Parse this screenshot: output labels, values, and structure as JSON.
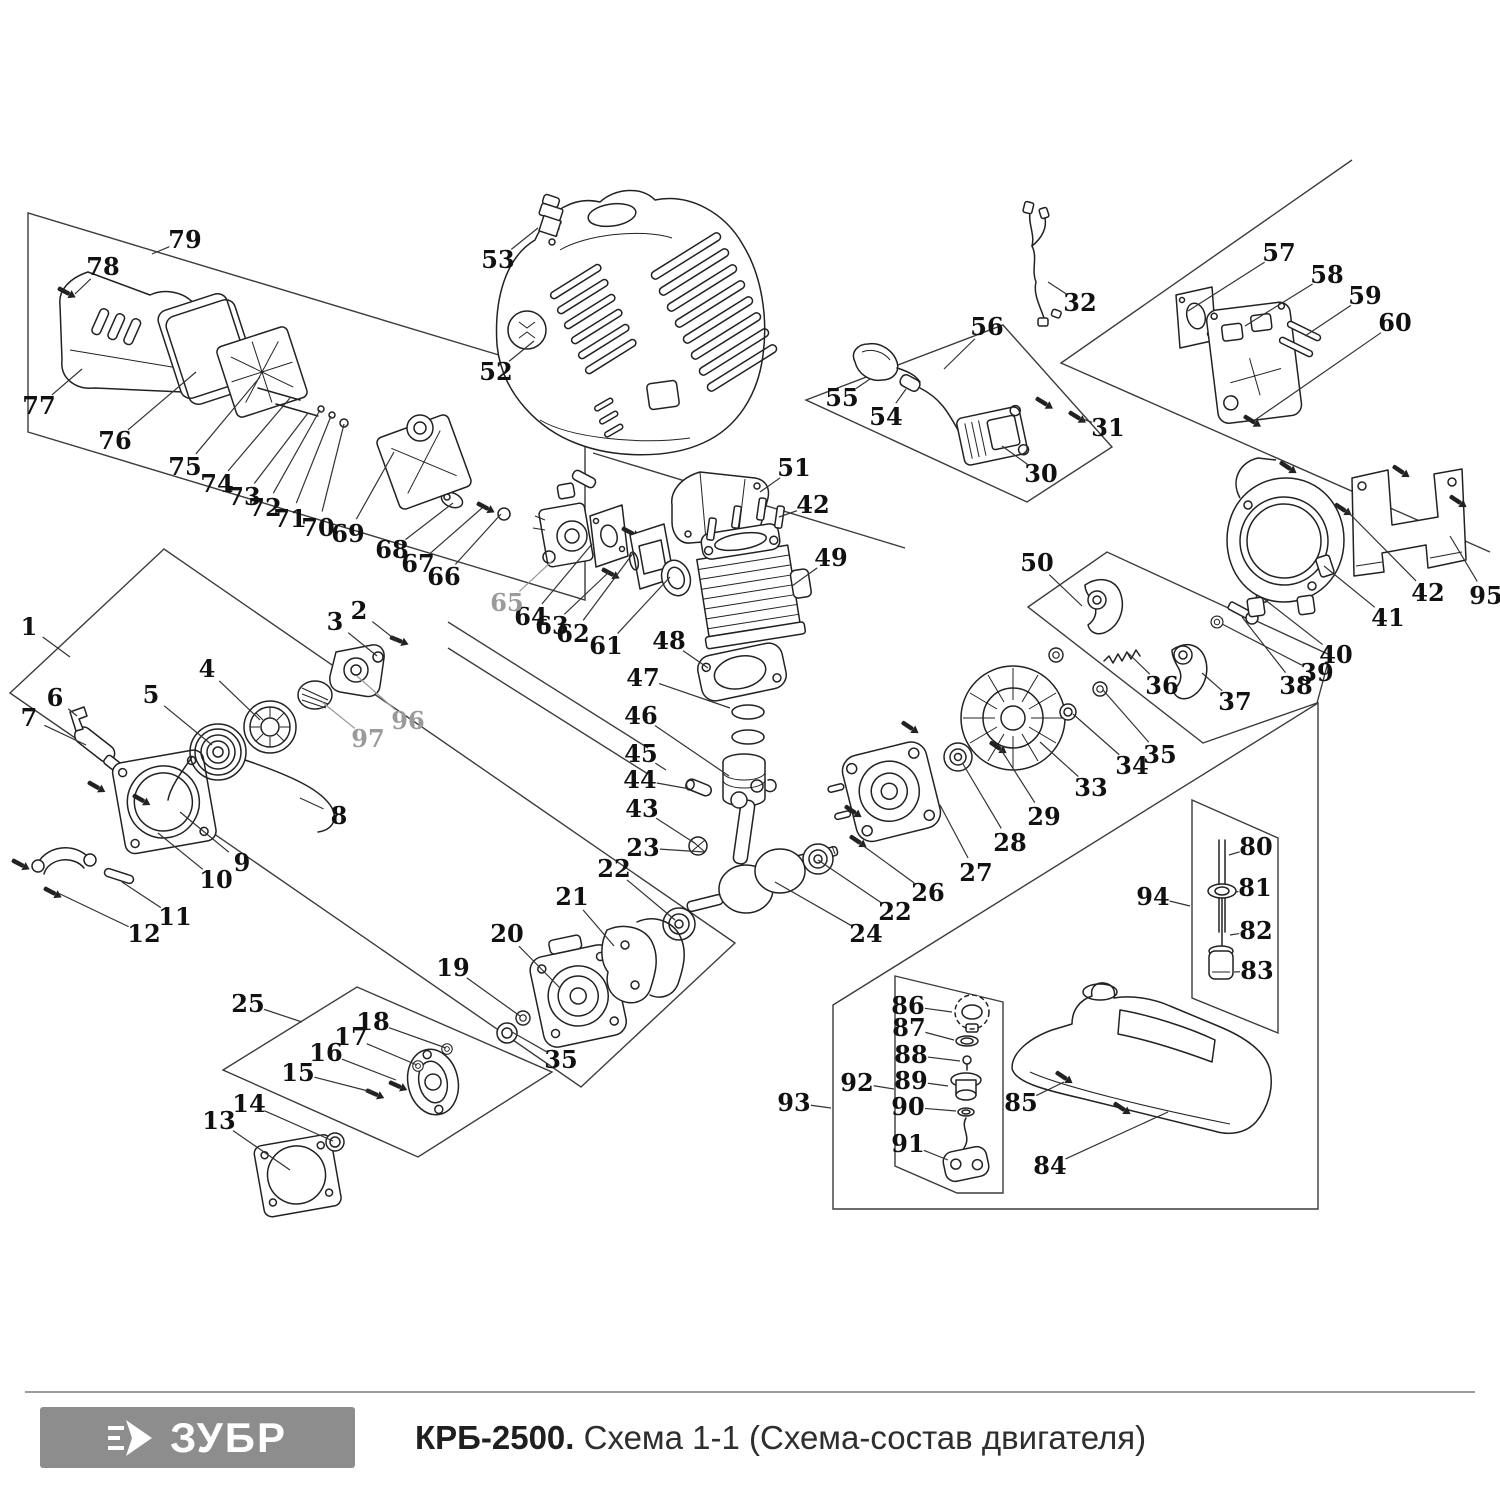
{
  "diagram": {
    "label_color": "#111111",
    "muted_label_color": "#9a9a9a",
    "leader_color": "#333333",
    "labels": [
      {
        "n": "1",
        "x": 29,
        "y": 627,
        "tx": 70,
        "ty": 657
      },
      {
        "n": "2",
        "x": 359,
        "y": 611,
        "tx": 397,
        "ty": 641
      },
      {
        "n": "3",
        "x": 335,
        "y": 622,
        "tx": 377,
        "ty": 656
      },
      {
        "n": "4",
        "x": 207,
        "y": 669,
        "tx": 260,
        "ty": 720
      },
      {
        "n": "5",
        "x": 151,
        "y": 695,
        "tx": 212,
        "ty": 745
      },
      {
        "n": "6",
        "x": 55,
        "y": 698,
        "tx": 77,
        "ty": 716
      },
      {
        "n": "7",
        "x": 29,
        "y": 718,
        "tx": 86,
        "ty": 745
      },
      {
        "n": "8",
        "x": 339,
        "y": 816,
        "tx": 300,
        "ty": 798
      },
      {
        "n": "9",
        "x": 242,
        "y": 863,
        "tx": 180,
        "ty": 812
      },
      {
        "n": "10",
        "x": 216,
        "y": 880,
        "tx": 158,
        "ty": 833
      },
      {
        "n": "11",
        "x": 175,
        "y": 917,
        "tx": 122,
        "ty": 882
      },
      {
        "n": "12",
        "x": 144,
        "y": 934,
        "tx": 58,
        "ty": 893
      },
      {
        "n": "13",
        "x": 219,
        "y": 1121,
        "tx": 290,
        "ty": 1170
      },
      {
        "n": "14",
        "x": 249,
        "y": 1104,
        "tx": 333,
        "ty": 1141
      },
      {
        "n": "15",
        "x": 298,
        "y": 1073,
        "tx": 372,
        "ty": 1092
      },
      {
        "n": "16",
        "x": 326,
        "y": 1053,
        "tx": 396,
        "ty": 1080
      },
      {
        "n": "17",
        "x": 351,
        "y": 1037,
        "tx": 417,
        "ty": 1065
      },
      {
        "n": "18",
        "x": 373,
        "y": 1022,
        "tx": 446,
        "ty": 1048
      },
      {
        "n": "19",
        "x": 453,
        "y": 968,
        "tx": 520,
        "ty": 1016
      },
      {
        "n": "20",
        "x": 507,
        "y": 934,
        "tx": 560,
        "ty": 988
      },
      {
        "n": "21",
        "x": 572,
        "y": 897,
        "tx": 614,
        "ty": 946
      },
      {
        "n": "22",
        "x": 614,
        "y": 869,
        "tx": 675,
        "ty": 920
      },
      {
        "n": "23",
        "x": 643,
        "y": 848,
        "tx": 704,
        "ty": 852
      },
      {
        "n": "24",
        "x": 866,
        "y": 934,
        "tx": 775,
        "ty": 882
      },
      {
        "n": "22",
        "x": 895,
        "y": 912,
        "tx": 818,
        "ty": 860
      },
      {
        "n": "25",
        "x": 248,
        "y": 1004,
        "tx": 302,
        "ty": 1022
      },
      {
        "n": "26",
        "x": 928,
        "y": 893,
        "tx": 858,
        "ty": 842
      },
      {
        "n": "27",
        "x": 976,
        "y": 873,
        "tx": 940,
        "ty": 805
      },
      {
        "n": "28",
        "x": 1010,
        "y": 843,
        "tx": 963,
        "ty": 764
      },
      {
        "n": "29",
        "x": 1044,
        "y": 817,
        "tx": 1000,
        "ty": 748
      },
      {
        "n": "30",
        "x": 1041,
        "y": 474,
        "tx": 1002,
        "ty": 446
      },
      {
        "n": "31",
        "x": 1108,
        "y": 428,
        "tx": 1080,
        "ty": 418
      },
      {
        "n": "32",
        "x": 1080,
        "y": 303,
        "tx": 1048,
        "ty": 282
      },
      {
        "n": "33",
        "x": 1091,
        "y": 788,
        "tx": 1040,
        "ty": 742
      },
      {
        "n": "34",
        "x": 1132,
        "y": 766,
        "tx": 1073,
        "ty": 714
      },
      {
        "n": "35",
        "x": 1160,
        "y": 755,
        "tx": 1103,
        "ty": 690
      },
      {
        "n": "36",
        "x": 1162,
        "y": 686,
        "tx": 1128,
        "ty": 653
      },
      {
        "n": "37",
        "x": 1235,
        "y": 702,
        "tx": 1202,
        "ty": 673
      },
      {
        "n": "38",
        "x": 1296,
        "y": 686,
        "tx": 1242,
        "ty": 617
      },
      {
        "n": "39",
        "x": 1317,
        "y": 673,
        "tx": 1222,
        "ty": 624
      },
      {
        "n": "40",
        "x": 1336,
        "y": 655,
        "tx": 1264,
        "ty": 599
      },
      {
        "n": "41",
        "x": 1388,
        "y": 618,
        "tx": 1324,
        "ty": 566
      },
      {
        "n": "42",
        "x": 813,
        "y": 505,
        "tx": 779,
        "ty": 517
      },
      {
        "n": "42",
        "x": 1428,
        "y": 593,
        "tx": 1345,
        "ty": 509
      },
      {
        "n": "43",
        "x": 642,
        "y": 809,
        "tx": 696,
        "ty": 844
      },
      {
        "n": "44",
        "x": 640,
        "y": 780,
        "tx": 690,
        "ty": 789
      },
      {
        "n": "45",
        "x": 641,
        "y": 754,
        "tx": 666,
        "ty": 770
      },
      {
        "n": "46",
        "x": 641,
        "y": 716,
        "tx": 729,
        "ty": 776
      },
      {
        "n": "47",
        "x": 643,
        "y": 678,
        "tx": 730,
        "ty": 708
      },
      {
        "n": "48",
        "x": 669,
        "y": 641,
        "tx": 708,
        "ty": 668
      },
      {
        "n": "49",
        "x": 831,
        "y": 558,
        "tx": 792,
        "ty": 586
      },
      {
        "n": "50",
        "x": 1037,
        "y": 563,
        "tx": 1082,
        "ty": 606
      },
      {
        "n": "51",
        "x": 794,
        "y": 468,
        "tx": 760,
        "ty": 492
      },
      {
        "n": "52",
        "x": 496,
        "y": 372,
        "tx": 534,
        "ty": 341
      },
      {
        "n": "53",
        "x": 498,
        "y": 260,
        "tx": 538,
        "ty": 228
      },
      {
        "n": "54",
        "x": 886,
        "y": 417,
        "tx": 906,
        "ty": 389
      },
      {
        "n": "55",
        "x": 842,
        "y": 398,
        "tx": 870,
        "ty": 379
      },
      {
        "n": "56",
        "x": 987,
        "y": 327,
        "tx": 944,
        "ty": 369
      },
      {
        "n": "57",
        "x": 1279,
        "y": 253,
        "tx": 1188,
        "ty": 311
      },
      {
        "n": "58",
        "x": 1327,
        "y": 275,
        "tx": 1245,
        "ty": 326
      },
      {
        "n": "59",
        "x": 1365,
        "y": 296,
        "tx": 1305,
        "ty": 336
      },
      {
        "n": "60",
        "x": 1395,
        "y": 323,
        "tx": 1255,
        "ty": 420
      },
      {
        "n": "61",
        "x": 606,
        "y": 646,
        "tx": 670,
        "ty": 577
      },
      {
        "n": "62",
        "x": 573,
        "y": 634,
        "tx": 634,
        "ty": 552
      },
      {
        "n": "63",
        "x": 552,
        "y": 626,
        "tx": 609,
        "ty": 572
      },
      {
        "n": "64",
        "x": 531,
        "y": 617,
        "tx": 592,
        "ty": 544
      },
      {
        "n": "65",
        "x": 507,
        "y": 603,
        "tx": 552,
        "ty": 561,
        "muted": true
      },
      {
        "n": "66",
        "x": 444,
        "y": 577,
        "tx": 501,
        "ty": 514
      },
      {
        "n": "67",
        "x": 418,
        "y": 564,
        "tx": 482,
        "ty": 508
      },
      {
        "n": "68",
        "x": 392,
        "y": 550,
        "tx": 453,
        "ty": 503
      },
      {
        "n": "69",
        "x": 348,
        "y": 534,
        "tx": 394,
        "ty": 452
      },
      {
        "n": "70",
        "x": 318,
        "y": 528,
        "tx": 344,
        "ty": 424
      },
      {
        "n": "71",
        "x": 290,
        "y": 519,
        "tx": 331,
        "ty": 416
      },
      {
        "n": "72",
        "x": 265,
        "y": 508,
        "tx": 320,
        "ty": 410
      },
      {
        "n": "73",
        "x": 244,
        "y": 497,
        "tx": 308,
        "ty": 413
      },
      {
        "n": "74",
        "x": 217,
        "y": 484,
        "tx": 290,
        "ty": 398
      },
      {
        "n": "75",
        "x": 185,
        "y": 467,
        "tx": 260,
        "ty": 377
      },
      {
        "n": "76",
        "x": 115,
        "y": 441,
        "tx": 196,
        "ty": 372
      },
      {
        "n": "77",
        "x": 39,
        "y": 406,
        "tx": 82,
        "ty": 369
      },
      {
        "n": "78",
        "x": 103,
        "y": 267,
        "tx": 75,
        "ty": 294
      },
      {
        "n": "79",
        "x": 185,
        "y": 240,
        "tx": 152,
        "ty": 254
      },
      {
        "n": "80",
        "x": 1256,
        "y": 847,
        "tx": 1229,
        "ty": 855
      },
      {
        "n": "81",
        "x": 1255,
        "y": 888,
        "tx": 1236,
        "ty": 892
      },
      {
        "n": "82",
        "x": 1256,
        "y": 931,
        "tx": 1230,
        "ty": 935
      },
      {
        "n": "83",
        "x": 1257,
        "y": 971,
        "tx": 1234,
        "ty": 972
      },
      {
        "n": "84",
        "x": 1050,
        "y": 1166,
        "tx": 1168,
        "ty": 1112
      },
      {
        "n": "85",
        "x": 1021,
        "y": 1103,
        "tx": 1064,
        "ty": 1082
      },
      {
        "n": "86",
        "x": 908,
        "y": 1006,
        "tx": 952,
        "ty": 1012
      },
      {
        "n": "87",
        "x": 909,
        "y": 1028,
        "tx": 954,
        "ty": 1040
      },
      {
        "n": "88",
        "x": 911,
        "y": 1055,
        "tx": 960,
        "ty": 1061
      },
      {
        "n": "89",
        "x": 911,
        "y": 1081,
        "tx": 948,
        "ty": 1086
      },
      {
        "n": "90",
        "x": 908,
        "y": 1107,
        "tx": 956,
        "ty": 1111
      },
      {
        "n": "91",
        "x": 908,
        "y": 1144,
        "tx": 948,
        "ty": 1160
      },
      {
        "n": "92",
        "x": 857,
        "y": 1083,
        "tx": 894,
        "ty": 1089
      },
      {
        "n": "93",
        "x": 794,
        "y": 1103,
        "tx": 831,
        "ty": 1108
      },
      {
        "n": "94",
        "x": 1153,
        "y": 897,
        "tx": 1190,
        "ty": 906
      },
      {
        "n": "95",
        "x": 1486,
        "y": 596,
        "tx": 1450,
        "ty": 536
      },
      {
        "n": "96",
        "x": 408,
        "y": 721,
        "tx": 357,
        "ty": 676,
        "muted": true
      },
      {
        "n": "97",
        "x": 368,
        "y": 739,
        "tx": 322,
        "ty": 702,
        "muted": true
      },
      {
        "n": "35",
        "x": 561,
        "y": 1060,
        "tx": 512,
        "ty": 1032
      }
    ]
  },
  "footer": {
    "separator_color": "#9c9c9c",
    "logo": {
      "text": "ЗУБР",
      "bg": "#8d8d8d",
      "fg": "#ffffff"
    },
    "title": {
      "model": "КРБ-2500.",
      "schema": " Схема 1-1 (Схема-состав двигателя)"
    }
  }
}
